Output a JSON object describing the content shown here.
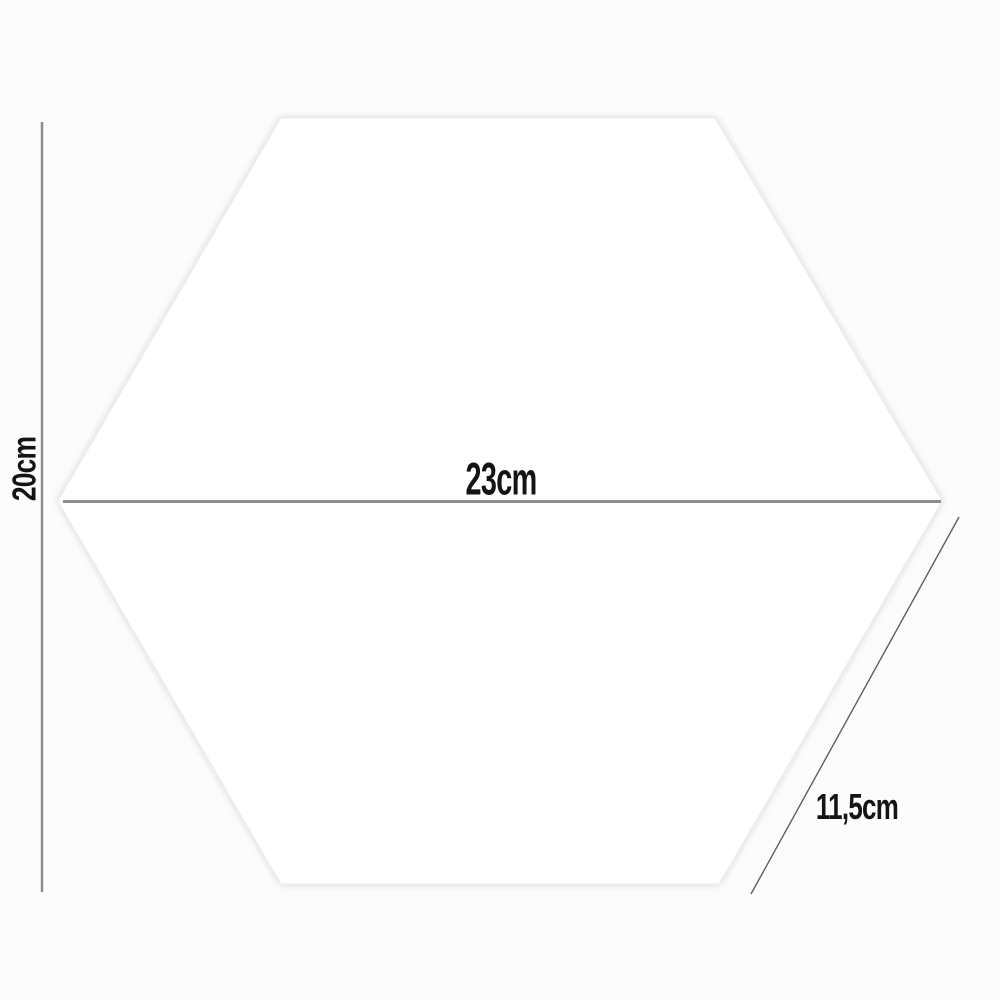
{
  "diagram": {
    "shape": "hexagon",
    "dimensions": [
      {
        "name": "height",
        "value": "20cm",
        "orientation": "vertical"
      },
      {
        "name": "width",
        "value": "23cm",
        "orientation": "horizontal"
      },
      {
        "name": "side",
        "value": "11,5cm",
        "orientation": "diagonal"
      }
    ],
    "colors": {
      "background": "#fcfcfc",
      "hexagon_fill": "#ffffff",
      "hexagon_edge": "#ededed",
      "dimension_line": "#8d8d8d",
      "side_line": "#5f5f5f",
      "text": "#141414"
    }
  }
}
